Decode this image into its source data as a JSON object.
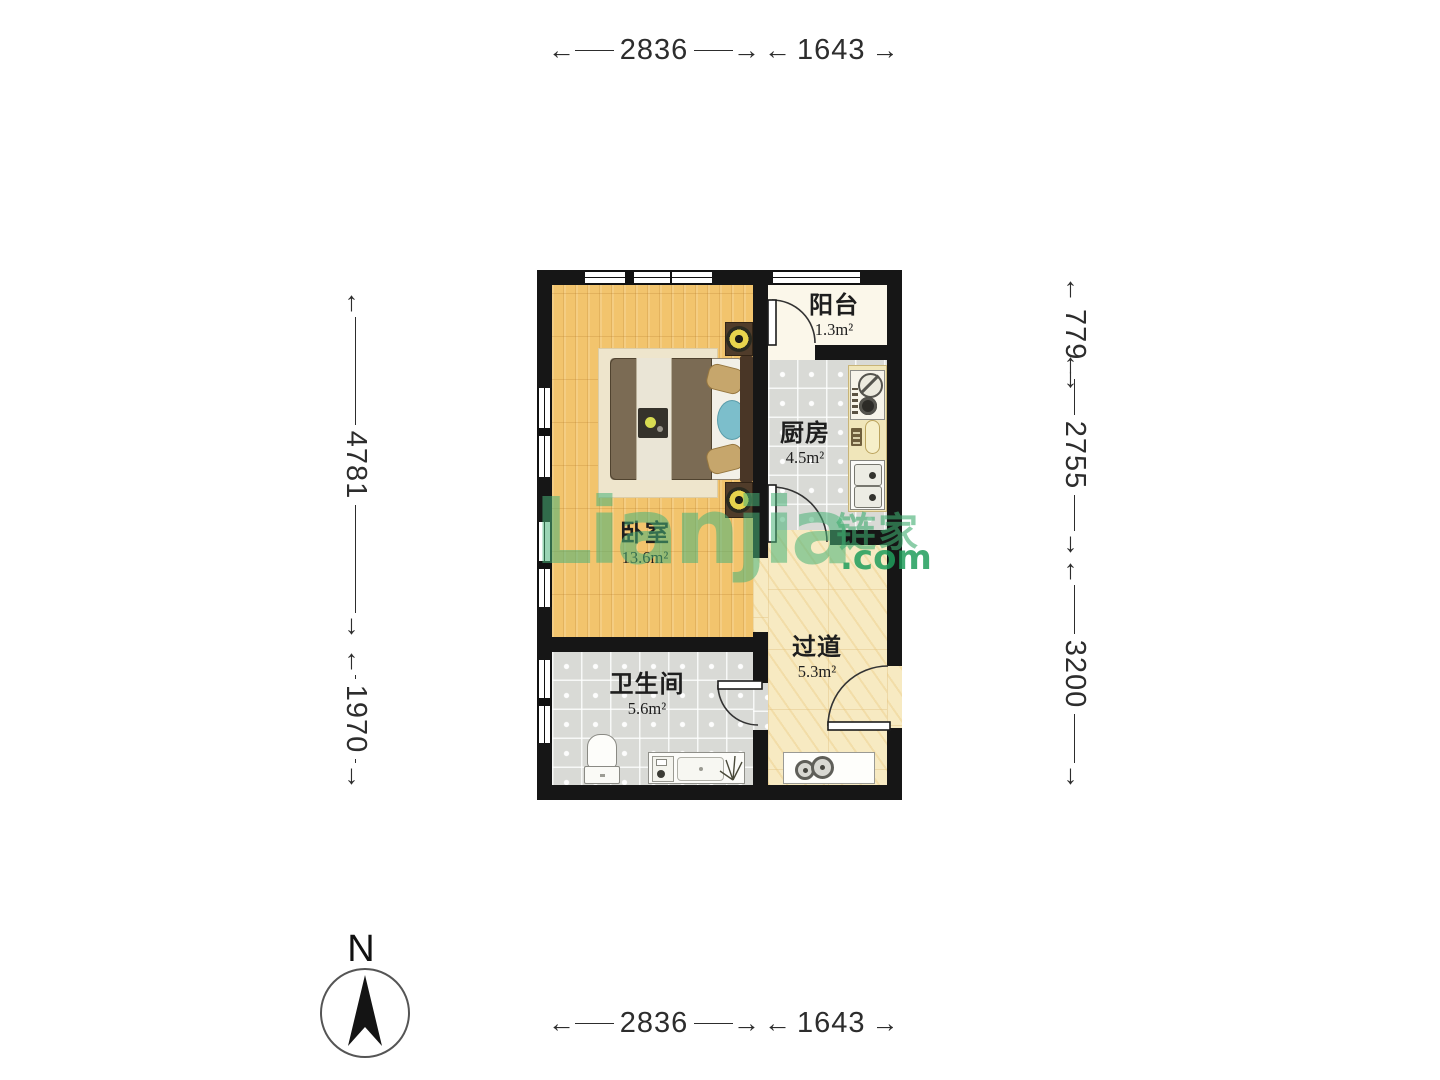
{
  "watermark": {
    "brand_latin": "Lianjia",
    "brand_cjk": "链家",
    "brand_tld": ".com"
  },
  "compass": {
    "north_label": "N"
  },
  "rooms": [
    {
      "name": "阳台",
      "area": "1.3m²"
    },
    {
      "name": "厨房",
      "area": "4.5m²"
    },
    {
      "name": "卧室",
      "area": "13.6m²"
    },
    {
      "name": "卫生间",
      "area": "5.6m²"
    },
    {
      "name": "过道",
      "area": "5.3m²"
    }
  ],
  "dimensions": {
    "top": [
      "2836",
      "1643"
    ],
    "bottom": [
      "2836",
      "1643"
    ],
    "left": [
      "4781",
      "1970"
    ],
    "right": [
      "779",
      "2755",
      "3200"
    ]
  },
  "colors": {
    "wall": "#161616",
    "wood_floor": "#F2C46D",
    "tile_floor": "#D9DAD6",
    "marble_floor": "#F7EAC2",
    "watermark_green": "#48B278"
  }
}
